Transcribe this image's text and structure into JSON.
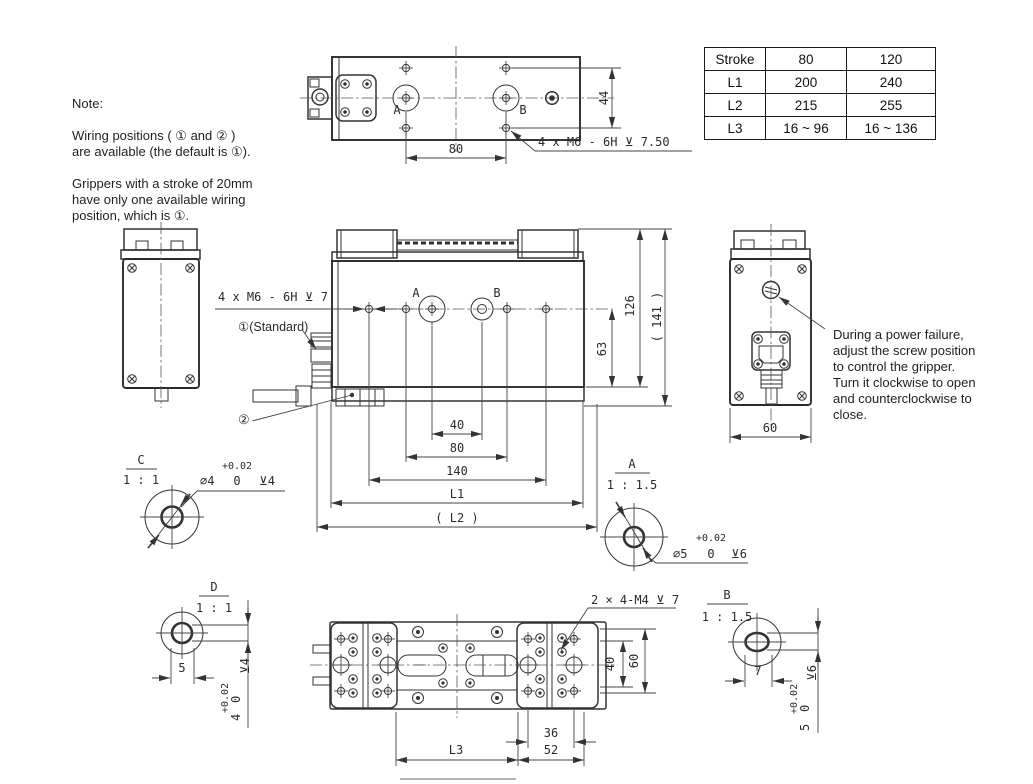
{
  "colors": {
    "line": "#333333",
    "background": "#ffffff"
  },
  "note": {
    "title": "Note:",
    "lines1": [
      "Wiring positions ( ① and ② )",
      "are available (the default is ①)."
    ],
    "lines2": [
      "Grippers with a stroke of 20mm",
      "have only one available wiring",
      "position, which is ①."
    ]
  },
  "power_failure_note": {
    "lines": [
      "During a power failure,",
      "adjust the screw position",
      "to control the gripper.",
      "Turn it clockwise to open",
      "and counterclockwise to",
      "close."
    ]
  },
  "spec_table": {
    "rows": [
      [
        "Stroke",
        "80",
        "120"
      ],
      [
        "L1",
        "200",
        "240"
      ],
      [
        "L2",
        "215",
        "255"
      ],
      [
        "L3",
        "16 ~ 96",
        "16 ~ 136"
      ]
    ]
  },
  "top_view": {
    "hole_a_label": "A",
    "hole_b_label": "B",
    "dim_hole_spacing": "80",
    "dim_height": "44",
    "thread_callout": "4 x M6 - 6H ⊻ 7.50"
  },
  "front_view": {
    "thread_callout": "4 x M6 - 6H ⊻ 7",
    "wiring_pos_1": "①(Standard)",
    "wiring_pos_2": "②",
    "hole_a_label": "A",
    "hole_b_label": "B",
    "dim_40": "40",
    "dim_80": "80",
    "dim_140": "140",
    "dim_l1": "L1",
    "dim_l2": "( L2 )",
    "dim_63": "63",
    "dim_126": "126",
    "dim_141": "( 141 )"
  },
  "side_view": {
    "dim_width": "60"
  },
  "bottom_view": {
    "thread_callout": "2 × 4-M4 ⊻ 7",
    "dim_36": "36",
    "dim_52": "52",
    "dim_l3": "L3",
    "dim_40": "40",
    "dim_60": "60"
  },
  "detail_c": {
    "label": "C",
    "scale": "1 : 1",
    "dia": "∅4",
    "tol_upper": "+0.02",
    "tol_lower": "0",
    "depth": "⊻4"
  },
  "detail_a": {
    "label": "A",
    "scale": "1 : 1.5",
    "dia": "∅5",
    "tol_upper": "+0.02",
    "tol_lower": "0",
    "depth": "⊻6"
  },
  "detail_d": {
    "label": "D",
    "scale": "1 : 1",
    "dim_width": "5",
    "nominal": "4",
    "tol_upper": "+0.02",
    "tol_lower": "0",
    "depth": "⊻4"
  },
  "detail_b": {
    "label": "B",
    "scale": "1 : 1.5",
    "dim_width": "7",
    "nominal": "5",
    "tol_upper": "+0.02",
    "tol_lower": "0",
    "depth": "⊻6"
  }
}
